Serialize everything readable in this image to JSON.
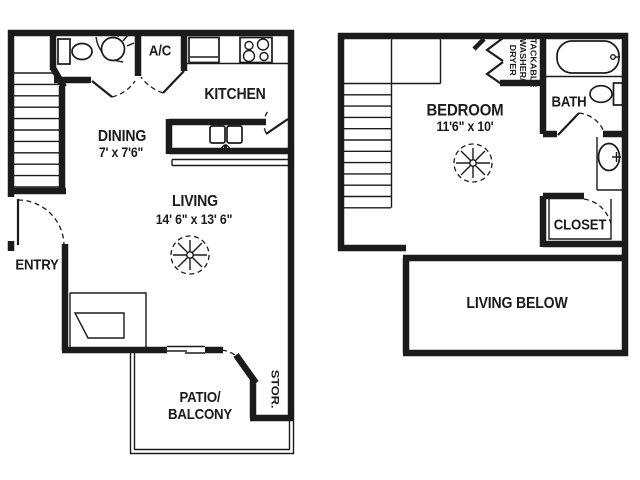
{
  "title": "Two-level apartment floor plan",
  "colors": {
    "ink": "#1b1b1b",
    "background": "#ffffff"
  },
  "floor1": {
    "rooms": {
      "ac": {
        "label": "A/C"
      },
      "kitchen": {
        "label": "KITCHEN"
      },
      "dining": {
        "label": "DINING",
        "dims": "7' x 7'6\""
      },
      "living": {
        "label": "LIVING",
        "dims": "14' 6\" x 13' 6\""
      },
      "entry": {
        "label": "ENTRY"
      },
      "patio": {
        "label": "PATIO/\nBALCONY"
      },
      "storage": {
        "label": "STOR."
      }
    }
  },
  "floor2": {
    "rooms": {
      "bedroom": {
        "label": "BEDROOM",
        "dims": "11'6\" x 10'"
      },
      "laundry": {
        "label": "STACKABLE\nWASHER/\nDRYER"
      },
      "bath": {
        "label": "BATH"
      },
      "closet": {
        "label": "CLOSET"
      },
      "living_below": {
        "label": "LIVING BELOW"
      }
    }
  }
}
